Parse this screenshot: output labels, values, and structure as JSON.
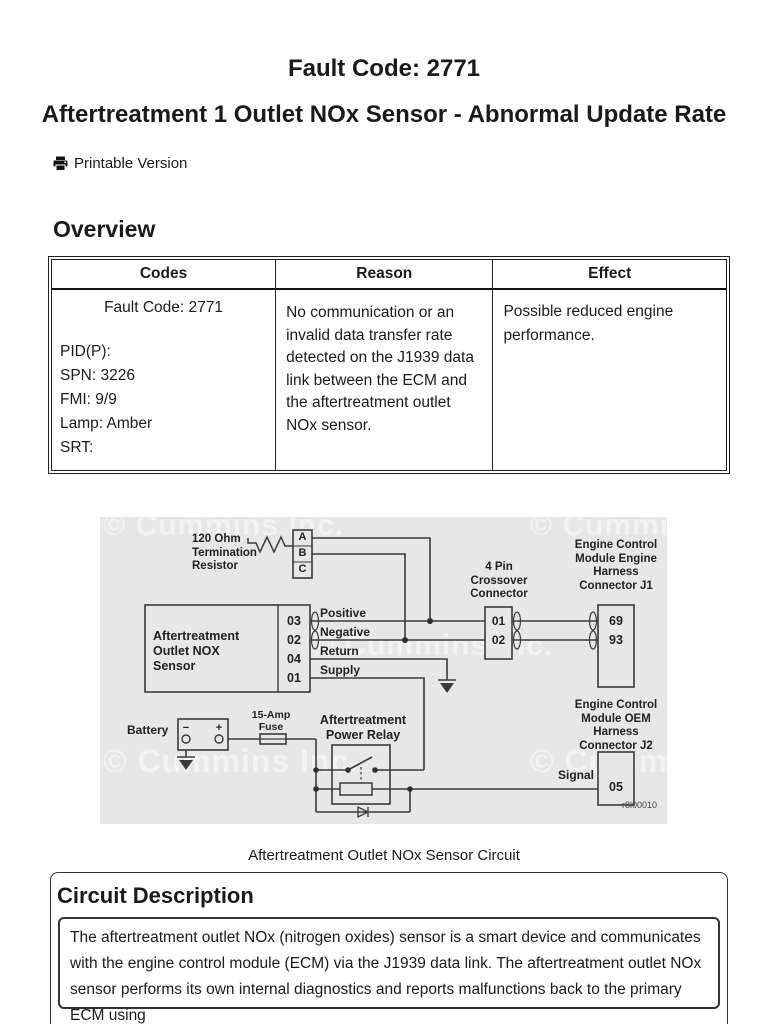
{
  "page": {
    "title": "Fault Code: 2771",
    "subtitle": "Aftertreatment 1 Outlet NOx Sensor - Abnormal Update Rate",
    "printable_label": "Printable Version"
  },
  "overview": {
    "heading": "Overview",
    "table": {
      "headers": [
        "Codes",
        "Reason",
        "Effect"
      ],
      "codes": {
        "fault_code": "Fault Code: 2771",
        "lines": "PID(P):\nSPN: 3226\nFMI: 9/9\nLamp: Amber\nSRT:"
      },
      "reason": "No communication or an invalid data transfer rate detected on the J1939 data link between the ECM and the aftertreatment outlet NOx sensor.",
      "effect": "Possible reduced engine performance."
    }
  },
  "diagram": {
    "watermark": "© Cummins Inc.",
    "termination_resistor_label": "120 Ohm\nTermination\nResistor",
    "abc_pins": [
      "A",
      "B",
      "C"
    ],
    "sensor_label": "Aftertreatment\nOutlet NOX\nSensor",
    "sensor_pins": [
      "03",
      "02",
      "04",
      "01"
    ],
    "wire_labels": [
      "Positive",
      "Negative",
      "Return",
      "Supply"
    ],
    "crossover_label": "4 Pin\nCrossover\nConnector",
    "crossover_pins": [
      "01",
      "02"
    ],
    "j1_label": "Engine Control\nModule Engine\nHarness\nConnector J1",
    "j1_pins": [
      "69",
      "93"
    ],
    "j2_label": "Engine Control\nModule OEM\nHarness\nConnector J2",
    "j2_pin": "05",
    "battery_label": "Battery",
    "battery_terminals": [
      "−",
      "+"
    ],
    "fuse_label": "15-Amp\nFuse",
    "relay_label": "Aftertreatment\nPower Relay",
    "signal_label": "Signal",
    "ref": "r8l00010"
  },
  "caption": "Aftertreatment Outlet NOx Sensor Circuit",
  "circuit_description": {
    "heading": "Circuit Description",
    "text": "The aftertreatment outlet NOx (nitrogen oxides) sensor is a smart device and communicates with the engine control module (ECM) via the J1939 data link. The aftertreatment outlet NOx sensor performs its own internal diagnostics and reports malfunctions back to the primary ECM using"
  },
  "colors": {
    "diagram_bg": "#e7e7e7",
    "line": "#3a3a3a",
    "watermark": "#f2f2f2"
  }
}
